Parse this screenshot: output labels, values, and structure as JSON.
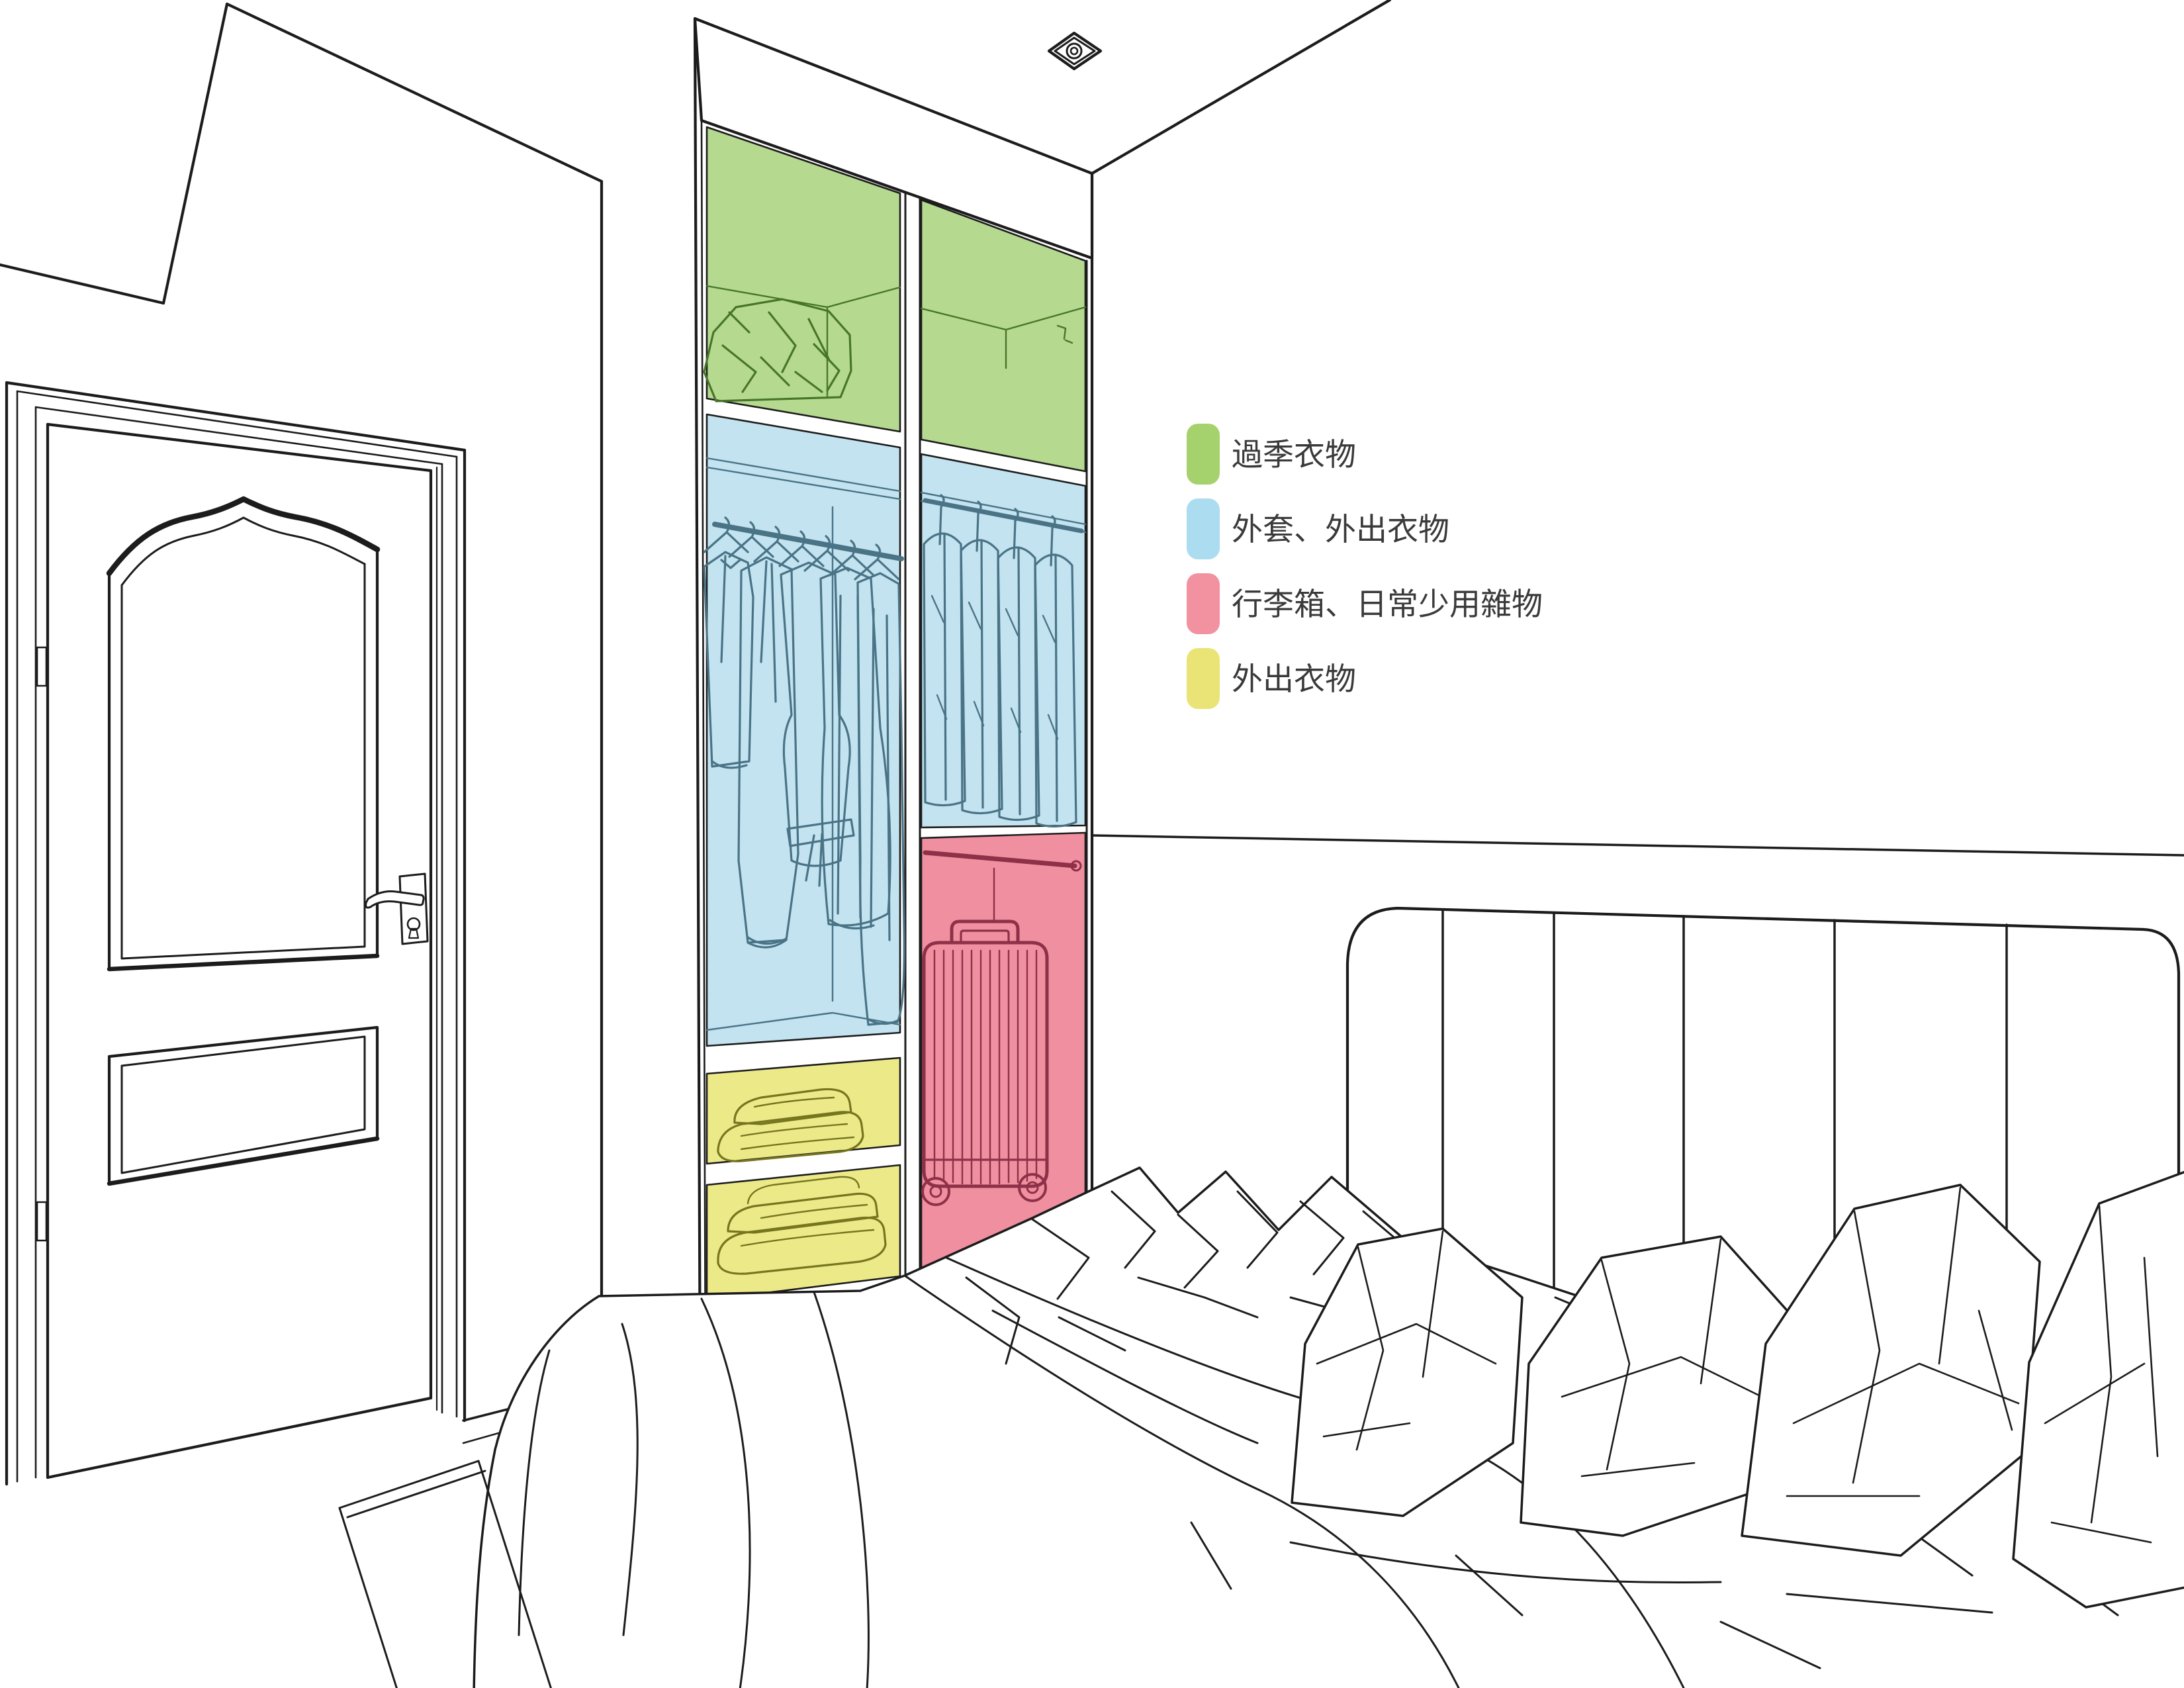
{
  "legend": {
    "items": [
      {
        "key": "offseason-clothes",
        "label": "過季衣物",
        "color": "#a6d26e"
      },
      {
        "key": "coats-outerwear",
        "label": "外套、外出衣物",
        "color": "#abdcf0"
      },
      {
        "key": "luggage-sundries",
        "label": "行李箱、日常少用雜物",
        "color": "#f2919f"
      },
      {
        "key": "outing-clothes",
        "label": "外出衣物",
        "color": "#e9e475"
      }
    ],
    "text_color": "#3a3a3a"
  },
  "zones": {
    "green": {
      "fill": "#b6d990",
      "ink": "#47762a"
    },
    "blue": {
      "fill": "#c2e3ef",
      "ink": "#4a7386"
    },
    "red": {
      "fill": "#ef8f9f",
      "ink": "#8e3048"
    },
    "yellow": {
      "fill": "#ece989",
      "ink": "#76761f"
    }
  },
  "scene": {
    "background": "#ffffff",
    "line_color": "#1c1c1c"
  }
}
